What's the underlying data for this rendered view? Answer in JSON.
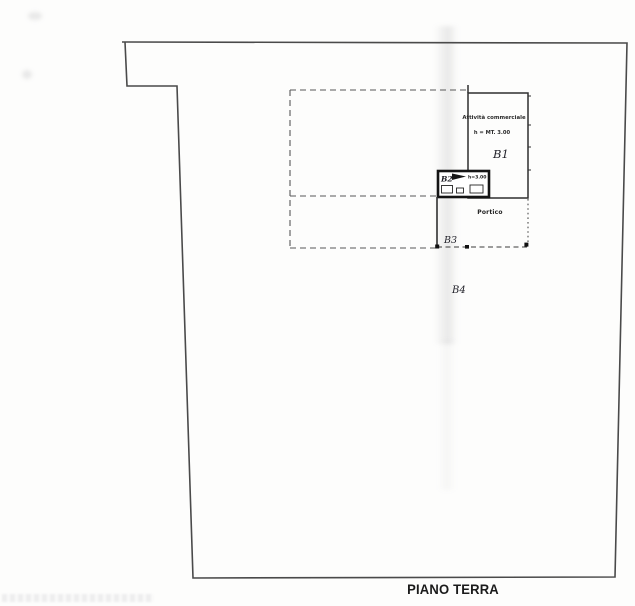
{
  "plan": {
    "title": "PIANO TERRA",
    "rooms": {
      "b1": {
        "label": "B1",
        "use": "Attività commerciale",
        "height": "h = MT. 3.00"
      },
      "b2": {
        "label": "B2",
        "height": "h=3.00"
      },
      "b3": {
        "label": "B3",
        "area": "Portico"
      },
      "b4": {
        "label": "B4"
      }
    }
  },
  "colors": {
    "boundary_ink": "#4a4a4a",
    "building_ink": "#2f2f2f",
    "thick_wall_ink": "#141414",
    "handwriting_ink": "#24242c",
    "paper": "#fdfdfc"
  }
}
